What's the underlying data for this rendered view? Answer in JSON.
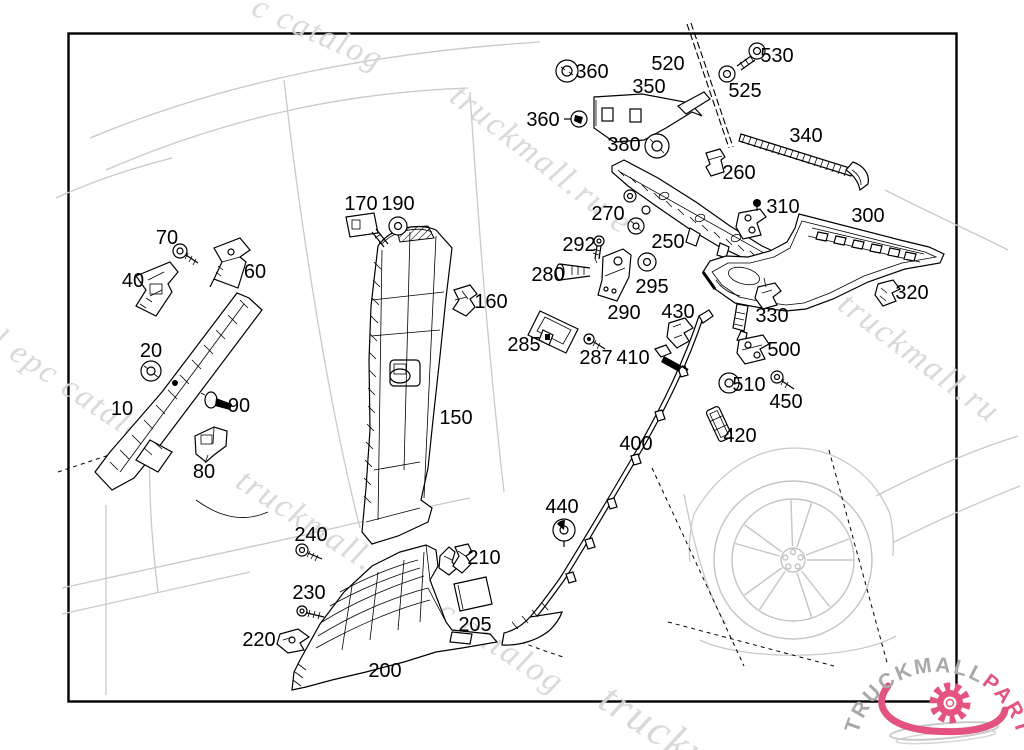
{
  "page": {
    "background": "#ffffff",
    "border_color": "#000000"
  },
  "watermark": {
    "text": "truckmall.ru epc catalog",
    "color": "#d6d6d6",
    "fragments": [
      "c catalog",
      "truckmall.ru e",
      "l epc catalog",
      "truckmall.ru",
      "truckmall.ru epc catalog",
      "truckm"
    ]
  },
  "logo": {
    "text_gray": "TRUCKMALL",
    "text_pink": "PARTS",
    "gray": "#a9a9a9",
    "pink": "#e4537f"
  },
  "callouts": [
    {
      "label": "360"
    },
    {
      "label": "520"
    },
    {
      "label": "530"
    },
    {
      "label": "525"
    },
    {
      "label": "350"
    },
    {
      "label": "360"
    },
    {
      "label": "380"
    },
    {
      "label": "340"
    },
    {
      "label": "260"
    },
    {
      "label": "170"
    },
    {
      "label": "190"
    },
    {
      "label": "270"
    },
    {
      "label": "310"
    },
    {
      "label": "300"
    },
    {
      "label": "70"
    },
    {
      "label": "292"
    },
    {
      "label": "250"
    },
    {
      "label": "60"
    },
    {
      "label": "40"
    },
    {
      "label": "280"
    },
    {
      "label": "295"
    },
    {
      "label": "160"
    },
    {
      "label": "320"
    },
    {
      "label": "290"
    },
    {
      "label": "430"
    },
    {
      "label": "330"
    },
    {
      "label": "20"
    },
    {
      "label": "285"
    },
    {
      "label": "287"
    },
    {
      "label": "410"
    },
    {
      "label": "500"
    },
    {
      "label": "510"
    },
    {
      "label": "90"
    },
    {
      "label": "10"
    },
    {
      "label": "450"
    },
    {
      "label": "150"
    },
    {
      "label": "420"
    },
    {
      "label": "80"
    },
    {
      "label": "400"
    },
    {
      "label": "440"
    },
    {
      "label": "240"
    },
    {
      "label": "210"
    },
    {
      "label": "230"
    },
    {
      "label": "205"
    },
    {
      "label": "220"
    },
    {
      "label": "200"
    }
  ]
}
